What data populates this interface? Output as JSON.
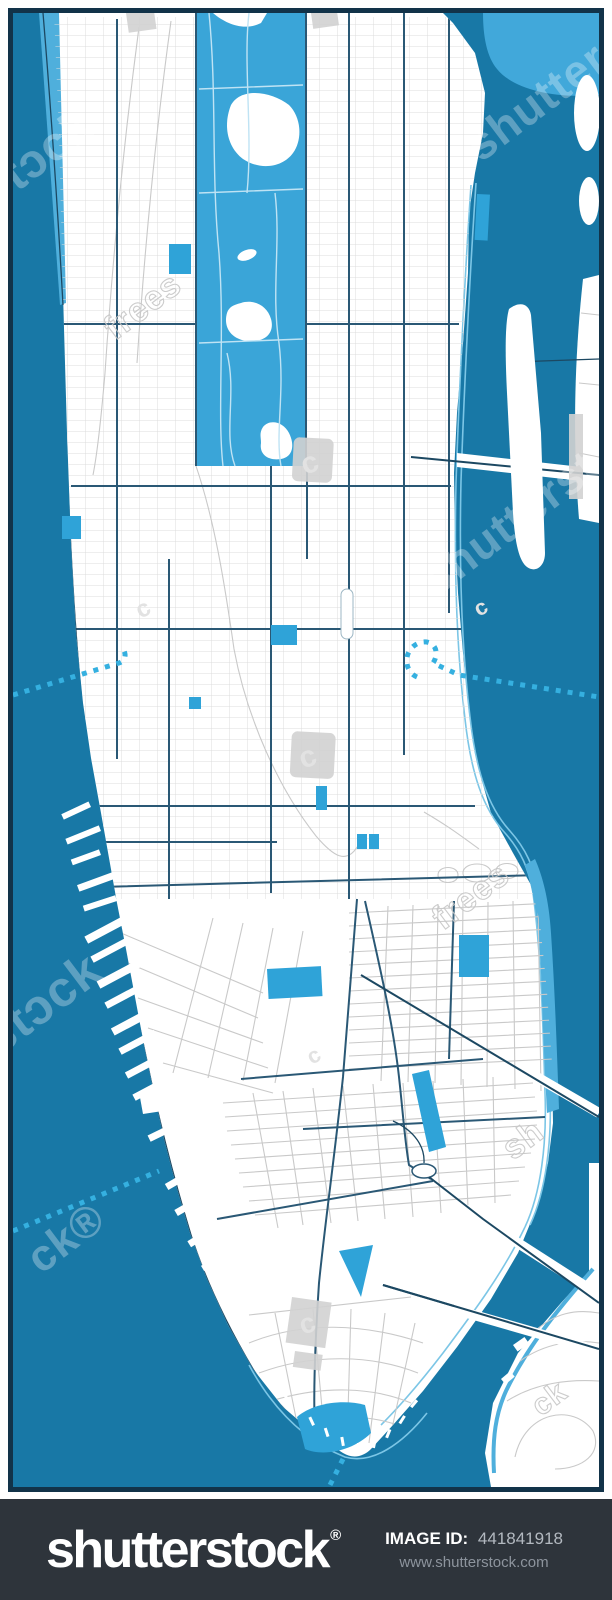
{
  "title": "Manhattan city vector map stock illustration (watermarked preview)",
  "watermark": {
    "brand": "shutterstock",
    "reg": "®",
    "fragments": {
      "left_top": "stɔck",
      "left_mid": "stɔck",
      "left_low": "ck®",
      "east_water": "shutterst",
      "top_right": "shutterstock",
      "land_a": "frees",
      "land_b": "frees",
      "land_c": "sh",
      "land_d": "ck",
      "glyph": "c"
    }
  },
  "footer": {
    "logo": "shutterstock",
    "reg": "®",
    "image_id_label": "IMAGE ID:",
    "image_id_value": "441841918",
    "website": "www.shutterstock.com"
  },
  "palette": {
    "water": "#1878a6",
    "land": "#ffffff",
    "park": "#3aa5d8",
    "patch": "#41a8da",
    "bluepark": "#2fa3d8",
    "lblue": "#7cc6e6",
    "lband": "#4fafdc",
    "navy": "#2a5875",
    "navy2": "#1c4862",
    "border": "#123349",
    "grid": "#dcdcdc",
    "grayst": "#c9c9c9",
    "bld": "#d2d2d2",
    "dot": "#35b0e0",
    "footer_bg": "#2e343b",
    "footer_muted": "#8d949d",
    "footer_value": "#b3b9c0"
  },
  "map": {
    "features": [
      "hudson-river",
      "east-river",
      "manhattan-island",
      "central-park",
      "street-grid",
      "piers",
      "bridges",
      "ferry-routes-dotted",
      "small-parks",
      "buildings",
      "roosevelt-island",
      "brooklyn-shore",
      "queens-shore",
      "battery-park"
    ]
  }
}
